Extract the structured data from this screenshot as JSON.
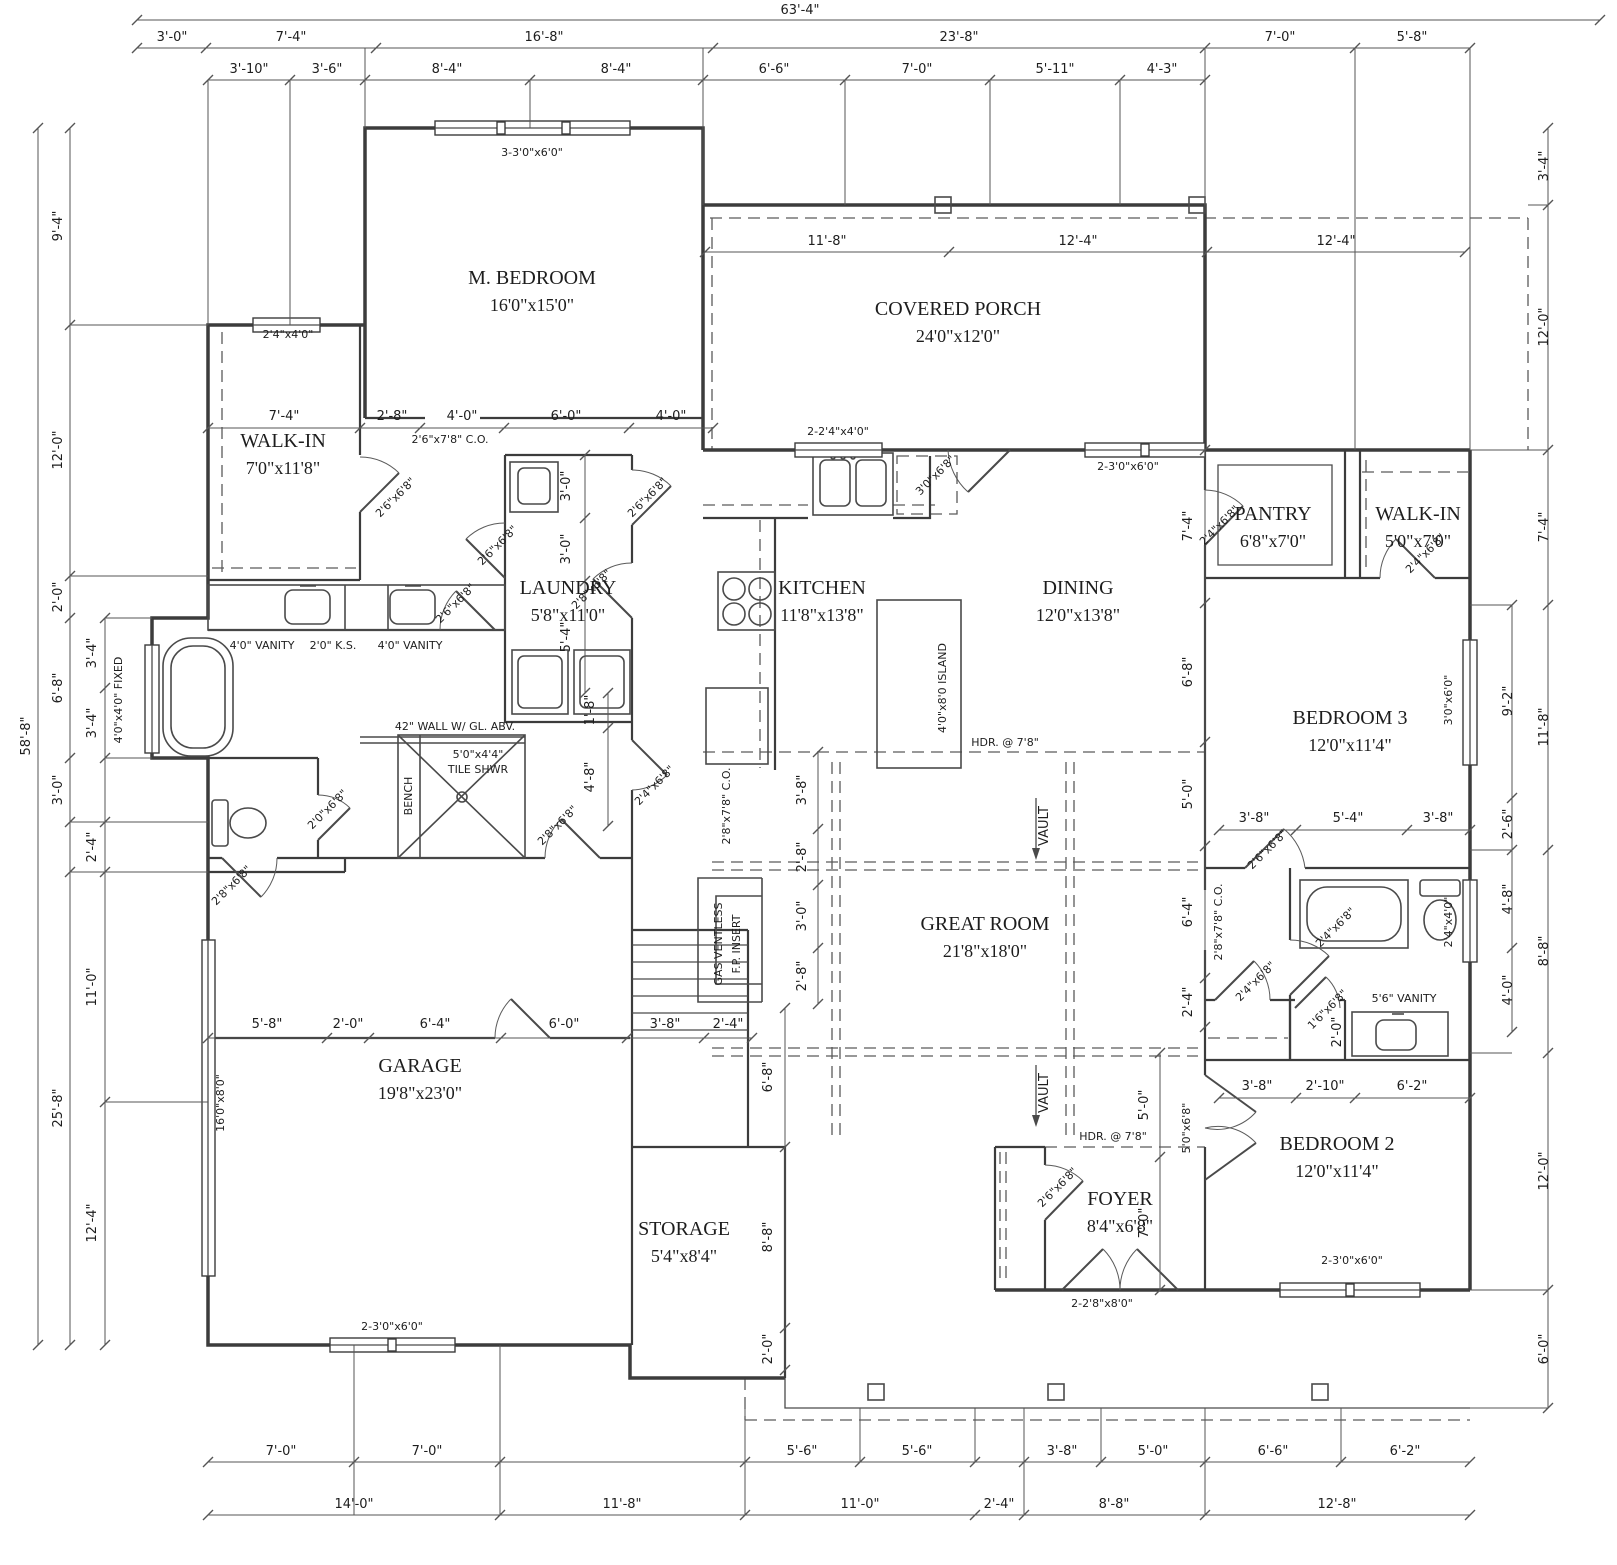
{
  "drawing": {
    "background": "#ffffff",
    "line_color": "#3c3c3c",
    "dim_color": "#555555",
    "text_color": "#1d1d1d"
  },
  "rooms": [
    {
      "name": "M. BEDROOM",
      "size": "16'0\"x15'0\"",
      "x": 532,
      "y": 284
    },
    {
      "name": "COVERED PORCH",
      "size": "24'0\"x12'0\"",
      "x": 958,
      "y": 315
    },
    {
      "name": "WALK-IN",
      "size": "7'0\"x11'8\"",
      "x": 283,
      "y": 447
    },
    {
      "name": "LAUNDRY",
      "size": "5'8\"x11'0\"",
      "x": 568,
      "y": 594
    },
    {
      "name": "KITCHEN",
      "size": "11'8\"x13'8\"",
      "x": 822,
      "y": 594
    },
    {
      "name": "DINING",
      "size": "12'0\"x13'8\"",
      "x": 1078,
      "y": 594
    },
    {
      "name": "PANTRY",
      "size": "6'8\"x7'0\"",
      "x": 1273,
      "y": 520
    },
    {
      "name": "WALK-IN",
      "size": "5'0\"x7'0\"",
      "x": 1418,
      "y": 520
    },
    {
      "name": "BEDROOM 3",
      "size": "12'0\"x11'4\"",
      "x": 1350,
      "y": 724
    },
    {
      "name": "GREAT ROOM",
      "size": "21'8\"x18'0\"",
      "x": 985,
      "y": 930
    },
    {
      "name": "GARAGE",
      "size": "19'8\"x23'0\"",
      "x": 420,
      "y": 1072
    },
    {
      "name": "STORAGE",
      "size": "5'4\"x8'4\"",
      "x": 684,
      "y": 1235
    },
    {
      "name": "FOYER",
      "size": "8'4\"x6'8\"",
      "x": 1120,
      "y": 1205
    },
    {
      "name": "BEDROOM 2",
      "size": "12'0\"x11'4\"",
      "x": 1337,
      "y": 1150
    }
  ],
  "labels": [
    {
      "t": "63'-4\"",
      "x": 800,
      "y": 14
    },
    {
      "t": "3'-0\"",
      "x": 172,
      "y": 41
    },
    {
      "t": "7'-4\"",
      "x": 291,
      "y": 41
    },
    {
      "t": "16'-8\"",
      "x": 544,
      "y": 41
    },
    {
      "t": "23'-8\"",
      "x": 959,
      "y": 41
    },
    {
      "t": "7'-0\"",
      "x": 1280,
      "y": 41
    },
    {
      "t": "5'-8\"",
      "x": 1412,
      "y": 41
    },
    {
      "t": "3'-10\"",
      "x": 249,
      "y": 73
    },
    {
      "t": "3'-6\"",
      "x": 327,
      "y": 73
    },
    {
      "t": "8'-4\"",
      "x": 447,
      "y": 73
    },
    {
      "t": "8'-4\"",
      "x": 616,
      "y": 73
    },
    {
      "t": "6'-6\"",
      "x": 774,
      "y": 73
    },
    {
      "t": "7'-0\"",
      "x": 917,
      "y": 73
    },
    {
      "t": "5'-11\"",
      "x": 1055,
      "y": 73
    },
    {
      "t": "4'-3\"",
      "x": 1162,
      "y": 73
    },
    {
      "t": "58'-8\"",
      "x": 30,
      "y": 736,
      "r": -90
    },
    {
      "t": "9'-4\"",
      "x": 62,
      "y": 226,
      "r": -90
    },
    {
      "t": "12'-0\"",
      "x": 62,
      "y": 450,
      "r": -90
    },
    {
      "t": "2'-0\"",
      "x": 62,
      "y": 597,
      "r": -90
    },
    {
      "t": "6'-8\"",
      "x": 62,
      "y": 688,
      "r": -90
    },
    {
      "t": "3'-0\"",
      "x": 62,
      "y": 790,
      "r": -90
    },
    {
      "t": "25'-8\"",
      "x": 62,
      "y": 1108,
      "r": -90
    },
    {
      "t": "3'-4\"",
      "x": 96,
      "y": 653,
      "r": -90
    },
    {
      "t": "3'-4\"",
      "x": 96,
      "y": 723,
      "r": -90
    },
    {
      "t": "2'-4\"",
      "x": 96,
      "y": 847,
      "r": -90
    },
    {
      "t": "11'-0\"",
      "x": 96,
      "y": 987,
      "r": -90
    },
    {
      "t": "12'-4\"",
      "x": 96,
      "y": 1223,
      "r": -90
    },
    {
      "t": "3'-4\"",
      "x": 1548,
      "y": 166,
      "r": -90
    },
    {
      "t": "12'-0\"",
      "x": 1548,
      "y": 327,
      "r": -90
    },
    {
      "t": "7'-4\"",
      "x": 1548,
      "y": 527,
      "r": -90
    },
    {
      "t": "11'-8\"",
      "x": 1548,
      "y": 727,
      "r": -90
    },
    {
      "t": "8'-8\"",
      "x": 1548,
      "y": 951,
      "r": -90
    },
    {
      "t": "12'-0\"",
      "x": 1548,
      "y": 1171,
      "r": -90
    },
    {
      "t": "6'-0\"",
      "x": 1548,
      "y": 1349,
      "r": -90
    },
    {
      "t": "9'-2\"",
      "x": 1512,
      "y": 701,
      "r": -90
    },
    {
      "t": "2'-6\"",
      "x": 1512,
      "y": 824,
      "r": -90
    },
    {
      "t": "4'-8\"",
      "x": 1512,
      "y": 899,
      "r": -90
    },
    {
      "t": "4'-0\"",
      "x": 1512,
      "y": 990,
      "r": -90
    },
    {
      "t": "7'-0\"",
      "x": 281,
      "y": 1455
    },
    {
      "t": "7'-0\"",
      "x": 427,
      "y": 1455
    },
    {
      "t": "5'-6\"",
      "x": 802,
      "y": 1455
    },
    {
      "t": "5'-6\"",
      "x": 917,
      "y": 1455
    },
    {
      "t": "3'-8\"",
      "x": 1062,
      "y": 1455
    },
    {
      "t": "5'-0\"",
      "x": 1153,
      "y": 1455
    },
    {
      "t": "6'-6\"",
      "x": 1273,
      "y": 1455
    },
    {
      "t": "6'-2\"",
      "x": 1405,
      "y": 1455
    },
    {
      "t": "14'-0\"",
      "x": 354,
      "y": 1508
    },
    {
      "t": "11'-8\"",
      "x": 622,
      "y": 1508
    },
    {
      "t": "11'-0\"",
      "x": 860,
      "y": 1508
    },
    {
      "t": "2'-4\"",
      "x": 999,
      "y": 1508
    },
    {
      "t": "8'-8\"",
      "x": 1114,
      "y": 1508
    },
    {
      "t": "12'-8\"",
      "x": 1337,
      "y": 1508
    },
    {
      "t": "7'-4\"",
      "x": 284,
      "y": 420
    },
    {
      "t": "2'-8\"",
      "x": 392,
      "y": 420
    },
    {
      "t": "4'-0\"",
      "x": 462,
      "y": 420
    },
    {
      "t": "6'-0\"",
      "x": 566,
      "y": 420
    },
    {
      "t": "4'-0\"",
      "x": 671,
      "y": 420
    },
    {
      "t": "11'-8\"",
      "x": 827,
      "y": 245
    },
    {
      "t": "12'-4\"",
      "x": 1078,
      "y": 245
    },
    {
      "t": "12'-4\"",
      "x": 1336,
      "y": 245
    },
    {
      "t": "3'-0\"",
      "x": 570,
      "y": 486,
      "r": -90
    },
    {
      "t": "3'-0\"",
      "x": 570,
      "y": 549,
      "r": -90
    },
    {
      "t": "5'-4\"",
      "x": 570,
      "y": 637,
      "r": -90
    },
    {
      "t": "1'-8\"",
      "x": 594,
      "y": 710,
      "r": -90
    },
    {
      "t": "4'-8\"",
      "x": 594,
      "y": 777,
      "r": -90
    },
    {
      "t": "7'-4\"",
      "x": 1192,
      "y": 526,
      "r": -90
    },
    {
      "t": "6'-8\"",
      "x": 1192,
      "y": 672,
      "r": -90
    },
    {
      "t": "5'-0\"",
      "x": 1192,
      "y": 794,
      "r": -90
    },
    {
      "t": "6'-4\"",
      "x": 1192,
      "y": 912,
      "r": -90
    },
    {
      "t": "2'-4\"",
      "x": 1192,
      "y": 1002,
      "r": -90
    },
    {
      "t": "3'-8\"",
      "x": 806,
      "y": 790,
      "r": -90
    },
    {
      "t": "2'-8\"",
      "x": 806,
      "y": 857,
      "r": -90
    },
    {
      "t": "3'-0\"",
      "x": 806,
      "y": 916,
      "r": -90
    },
    {
      "t": "2'-8\"",
      "x": 806,
      "y": 976,
      "r": -90
    },
    {
      "t": "5'-8\"",
      "x": 267,
      "y": 1028
    },
    {
      "t": "2'-0\"",
      "x": 348,
      "y": 1028
    },
    {
      "t": "6'-4\"",
      "x": 435,
      "y": 1028
    },
    {
      "t": "6'-0\"",
      "x": 564,
      "y": 1028
    },
    {
      "t": "3'-8\"",
      "x": 665,
      "y": 1028
    },
    {
      "t": "2'-4\"",
      "x": 728,
      "y": 1028
    },
    {
      "t": "6'-8\"",
      "x": 772,
      "y": 1077,
      "r": -90
    },
    {
      "t": "8'-8\"",
      "x": 772,
      "y": 1237,
      "r": -90
    },
    {
      "t": "2'-0\"",
      "x": 772,
      "y": 1349,
      "r": -90
    },
    {
      "t": "5'-0\"",
      "x": 1148,
      "y": 1105,
      "r": -90
    },
    {
      "t": "7'-0\"",
      "x": 1148,
      "y": 1223,
      "r": -90
    },
    {
      "t": "3'-8\"",
      "x": 1254,
      "y": 822
    },
    {
      "t": "5'-4\"",
      "x": 1348,
      "y": 822
    },
    {
      "t": "3'-8\"",
      "x": 1438,
      "y": 822
    },
    {
      "t": "3'-8\"",
      "x": 1257,
      "y": 1090
    },
    {
      "t": "2'-10\"",
      "x": 1325,
      "y": 1090
    },
    {
      "t": "6'-2\"",
      "x": 1412,
      "y": 1090
    },
    {
      "t": "2'-0\"",
      "x": 1341,
      "y": 1032,
      "r": -90
    },
    {
      "t": "HDR. @ 7'8\"",
      "x": 1005,
      "y": 746,
      "c": "sm"
    },
    {
      "t": "HDR. @ 7'8\"",
      "x": 1113,
      "y": 1140,
      "c": "sm"
    },
    {
      "t": "VAULT",
      "x": 1048,
      "y": 826,
      "r": -90
    },
    {
      "t": "VAULT",
      "x": 1048,
      "y": 1093,
      "r": -90
    },
    {
      "t": "3-3'0\"x6'0\"",
      "x": 532,
      "y": 156,
      "c": "sm"
    },
    {
      "t": "2'4\"x4'0\"",
      "x": 288,
      "y": 338,
      "c": "sm"
    },
    {
      "t": "2-2'4\"x4'0\"",
      "x": 838,
      "y": 435,
      "c": "sm"
    },
    {
      "t": "3'0\"x6'8\"",
      "x": 938,
      "y": 478,
      "r": -45,
      "c": "sm"
    },
    {
      "t": "2-3'0\"x6'0\"",
      "x": 1128,
      "y": 470,
      "c": "sm"
    },
    {
      "t": "2-3'0\"x6'0\"",
      "x": 392,
      "y": 1330,
      "c": "sm"
    },
    {
      "t": "2-3'0\"x6'0\"",
      "x": 1352,
      "y": 1264,
      "c": "sm"
    },
    {
      "t": "2-2'8\"x8'0\"",
      "x": 1102,
      "y": 1307,
      "c": "sm"
    },
    {
      "t": "16'0\"x8'0\"",
      "x": 224,
      "y": 1103,
      "r": -90,
      "c": "sm"
    },
    {
      "t": "4'0\"x4'0\" FIXED",
      "x": 122,
      "y": 700,
      "r": -90,
      "c": "sm"
    },
    {
      "t": "42\" WALL W/ GL. ABV.",
      "x": 455,
      "y": 730,
      "c": "sm"
    },
    {
      "t": "5'0\"x4'4\"",
      "x": 478,
      "y": 758,
      "c": "sm"
    },
    {
      "t": "TILE SHWR",
      "x": 478,
      "y": 773,
      "c": "sm"
    },
    {
      "t": "BENCH",
      "x": 412,
      "y": 796,
      "r": -90,
      "c": "sm"
    },
    {
      "t": "GAS VENTLESS",
      "x": 722,
      "y": 944,
      "r": -90,
      "c": "sm"
    },
    {
      "t": "F.P. INSERT",
      "x": 740,
      "y": 944,
      "r": -90,
      "c": "sm"
    },
    {
      "t": "4'0\"x8'0 ISLAND",
      "x": 946,
      "y": 688,
      "r": -90,
      "c": "sm"
    },
    {
      "t": "4'0\" VANITY",
      "x": 262,
      "y": 649,
      "c": "sm"
    },
    {
      "t": "2'0\" K.S.",
      "x": 333,
      "y": 649,
      "c": "sm"
    },
    {
      "t": "4'0\" VANITY",
      "x": 410,
      "y": 649,
      "c": "sm"
    },
    {
      "t": "5'6\" VANITY",
      "x": 1404,
      "y": 1002,
      "c": "sm"
    },
    {
      "t": "2'6\"x7'8\" C.O.",
      "x": 450,
      "y": 443,
      "c": "sm"
    },
    {
      "t": "2'6\"x6'8\"",
      "x": 398,
      "y": 500,
      "r": -45,
      "c": "sm"
    },
    {
      "t": "2'6\"x6'8\"",
      "x": 500,
      "y": 548,
      "r": -45,
      "c": "sm"
    },
    {
      "t": "2'6\"x6'8\"",
      "x": 458,
      "y": 606,
      "r": -45,
      "c": "sm"
    },
    {
      "t": "2'6\"x6'8\"",
      "x": 650,
      "y": 500,
      "r": -45,
      "c": "sm"
    },
    {
      "t": "2'8\"x6'8\"",
      "x": 594,
      "y": 592,
      "r": -45,
      "c": "sm"
    },
    {
      "t": "2'8\"x6'8\"",
      "x": 560,
      "y": 828,
      "r": -45,
      "c": "sm"
    },
    {
      "t": "2'8\"x6'8\"",
      "x": 234,
      "y": 888,
      "r": -45,
      "c": "sm"
    },
    {
      "t": "2'0\"x6'8\"",
      "x": 330,
      "y": 812,
      "r": -45,
      "c": "sm"
    },
    {
      "t": "2'4\"x6'8\"",
      "x": 657,
      "y": 788,
      "r": -45,
      "c": "sm"
    },
    {
      "t": "2'4\"x6'8\"",
      "x": 1222,
      "y": 528,
      "r": -45,
      "c": "sm"
    },
    {
      "t": "2'4\"x6'8\"",
      "x": 1428,
      "y": 556,
      "r": -45,
      "c": "sm"
    },
    {
      "t": "2'6\"x6'8\"",
      "x": 1270,
      "y": 852,
      "r": -45,
      "c": "sm"
    },
    {
      "t": "2'4\"x6'8\"",
      "x": 1338,
      "y": 930,
      "r": -45,
      "c": "sm"
    },
    {
      "t": "2'4\"x6'8\"",
      "x": 1258,
      "y": 984,
      "r": -45,
      "c": "sm"
    },
    {
      "t": "1'6\"x6'8\"",
      "x": 1330,
      "y": 1012,
      "r": -45,
      "c": "sm"
    },
    {
      "t": "2'8\"x7'8\" C.O.",
      "x": 1222,
      "y": 922,
      "r": -90,
      "c": "sm"
    },
    {
      "t": "2'8\"x7'8\" C.O.",
      "x": 730,
      "y": 806,
      "r": -90,
      "c": "sm"
    },
    {
      "t": "5'0\"x6'8\"",
      "x": 1190,
      "y": 1128,
      "r": -90,
      "c": "sm"
    },
    {
      "t": "3'0\"x6'0\"",
      "x": 1452,
      "y": 700,
      "r": -90,
      "c": "sm"
    },
    {
      "t": "2'4\"x4'0\"",
      "x": 1452,
      "y": 922,
      "r": -90,
      "c": "sm"
    },
    {
      "t": "2'6\"x6'8\"",
      "x": 1060,
      "y": 1190,
      "r": -45,
      "c": "sm"
    }
  ]
}
